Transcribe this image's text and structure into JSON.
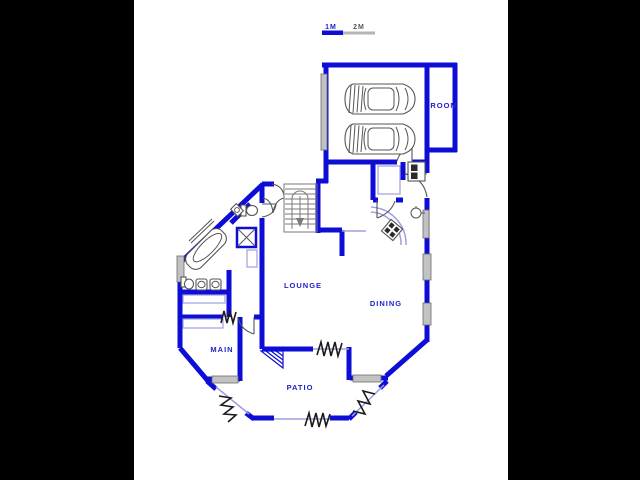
{
  "canvas": {
    "background": "#000000",
    "paper": "#ffffff"
  },
  "scale_bar": {
    "label_1m": "1M",
    "label_2m": "2M"
  },
  "rooms": {
    "room": {
      "label": "ROOM"
    },
    "lounge": {
      "label": "LOUNGE"
    },
    "dining": {
      "label": "DINING"
    },
    "main": {
      "label": "MAIN"
    },
    "patio": {
      "label": "PATIO"
    }
  },
  "colors": {
    "wall": "#0d0dd6",
    "thin": "#9f9fe0",
    "label": "#2222cc",
    "fixture": "#555555",
    "window": "#c2c2c2",
    "zigzag": "#1a1a1a"
  }
}
